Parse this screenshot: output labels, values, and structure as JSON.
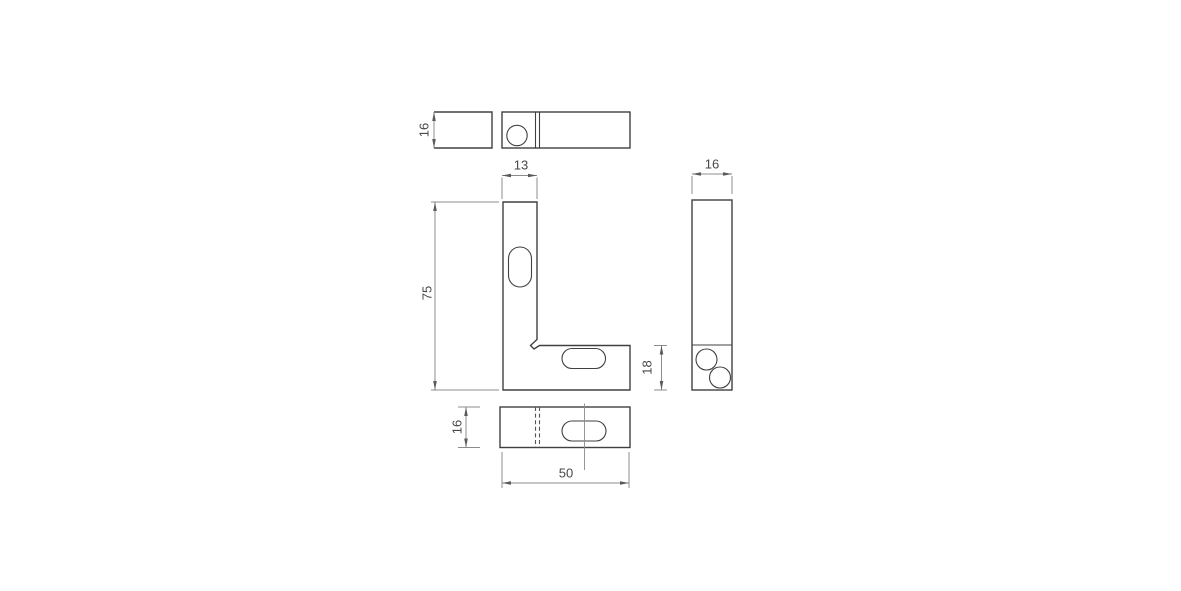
{
  "drawing": {
    "colors": {
      "background": "#ffffff",
      "outline": "#404040",
      "dimension_lines": "#8c8c8c",
      "text": "#474747"
    },
    "dimensions": {
      "top_view_depth": "16",
      "front_leg_width": "13",
      "front_height": "75",
      "front_base_thickness": "18",
      "side_view_width": "16",
      "bottom_view_depth": "16",
      "bottom_view_length": "50"
    }
  }
}
